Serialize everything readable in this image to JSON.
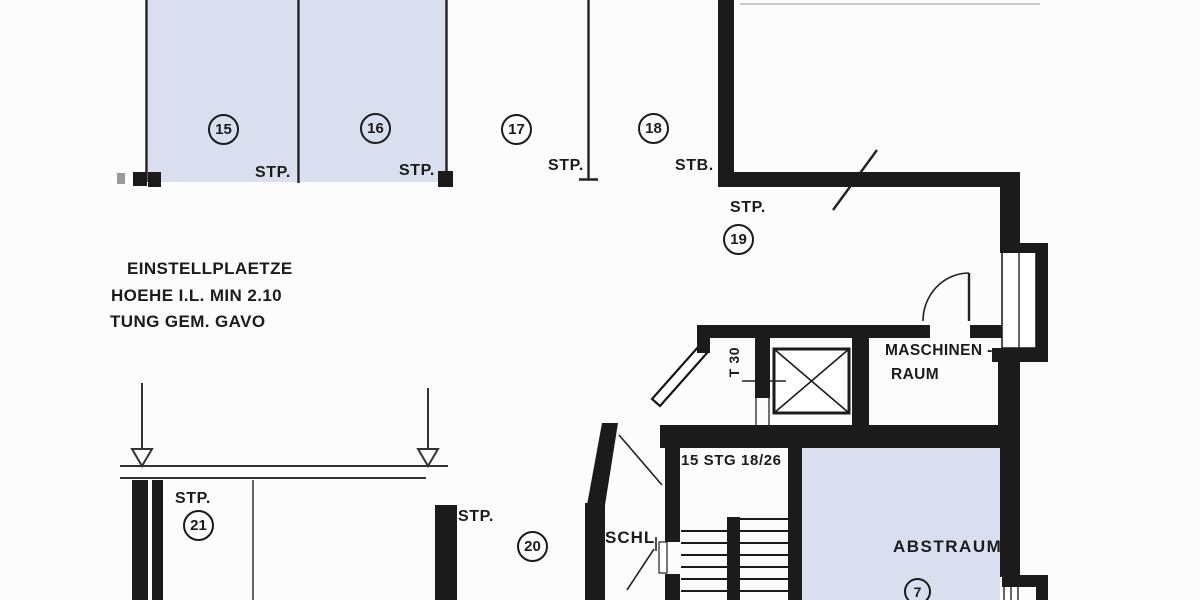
{
  "plan_title": "basement parking floor plan (scan)",
  "colors": {
    "wall": "#1b1b1b",
    "ink": "#1b1b1b",
    "stall_fill": "#dadff0",
    "paper": "#fcfcfc",
    "faint_line": "#b8b8b8"
  },
  "notes": {
    "line1": "EINSTELLPLAETZE",
    "line2": "HOEHE I.L. MIN 2.10",
    "line3": "TUNG GEM. GAVO"
  },
  "stalls": {
    "s15": {
      "number": "15",
      "tag": "STP."
    },
    "s16": {
      "number": "16",
      "tag": "STP."
    },
    "s17": {
      "number": "17",
      "tag": "STP."
    },
    "s18": {
      "number": "18",
      "tag": "STB."
    },
    "s19": {
      "number": "19",
      "tag": "STP."
    },
    "s20": {
      "number": "20",
      "tag": "STP."
    },
    "s21": {
      "number": "21",
      "tag": "STP."
    }
  },
  "rooms": {
    "maschinenraum": {
      "line1": "MASCHINEN -",
      "line2": "RAUM"
    },
    "abstraum": {
      "label": "ABSTRAUM",
      "number": "7"
    },
    "stairwell": {
      "label": "15 STG 18/26"
    },
    "schleuse": {
      "label": "SCHL"
    }
  },
  "door": {
    "label": "T 30"
  }
}
